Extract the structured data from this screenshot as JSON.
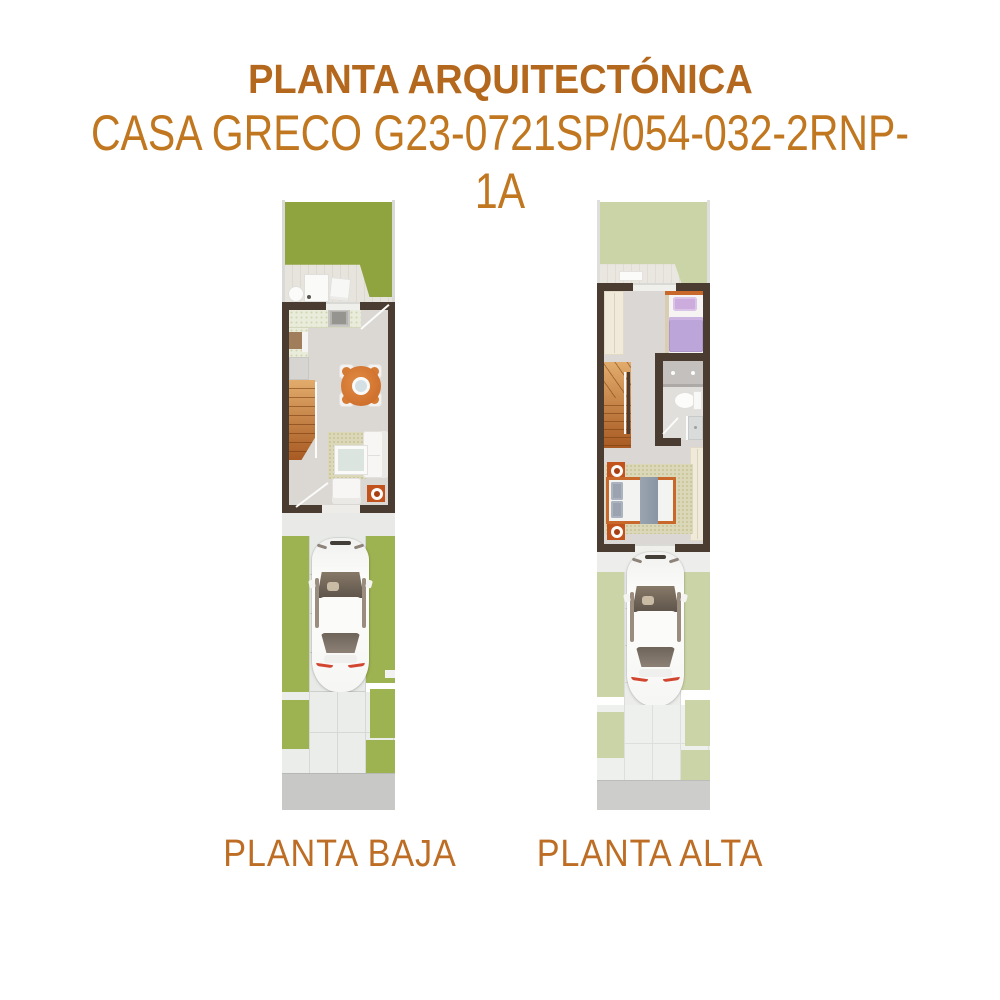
{
  "header": {
    "title": "PLANTA ARQUITECTÓNICA",
    "subtitle": "CASA GRECO G23-0721SP/054-032-2RNP-1A"
  },
  "floors": {
    "left_label": "PLANTA BAJA",
    "right_label": "PLANTA ALTA"
  },
  "palette": {
    "title_color": "#B4681D",
    "subtitle_color": "#C1771F",
    "label_color": "#BD6D24",
    "wall": "#4B3C31",
    "floor": "#DBD8D4",
    "grass_back": "#8FA43F",
    "grass_front": "#9DB250",
    "grass_faded": "#CBD4A6",
    "counter": "#EAECDB",
    "rug": "#DBD8B9",
    "wood_light": "#E2AC6C",
    "wood_dark": "#A85A22",
    "table_orange": "#C96625",
    "accent_orange": "#C2531D",
    "bed_frame": "#C8682B",
    "purple": "#BCA5D8",
    "concrete": "#E8EAE7",
    "sidewalk": "#C8C9C7"
  }
}
